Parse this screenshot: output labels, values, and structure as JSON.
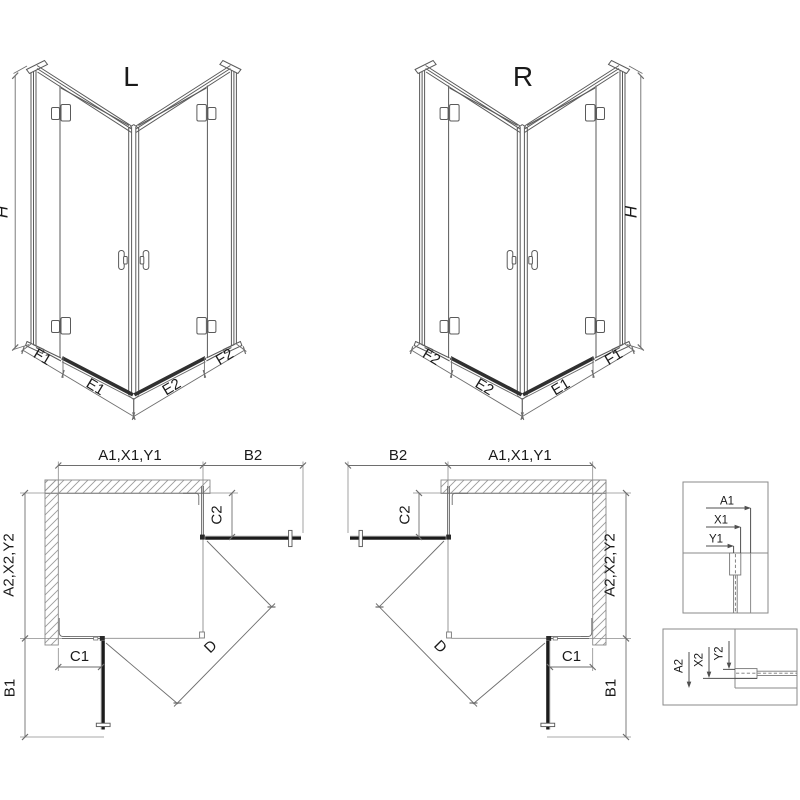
{
  "colors": {
    "line": "#5a5a5a",
    "dim": "#6e6e6e",
    "dark": "#1b1b1b",
    "threshold": "#303030",
    "hatch": "#9b9b9b",
    "frame": "#8a8a8a",
    "text": "#1a1a1a",
    "background": "#ffffff"
  },
  "iso_left": {
    "variant": "L",
    "height": "H",
    "seg1": "F1",
    "seg2": "E1",
    "seg3": "E2",
    "seg4": "F2"
  },
  "iso_right": {
    "variant": "R",
    "height": "H",
    "seg1": "F2",
    "seg2": "E2",
    "seg3": "E1",
    "seg4": "F1"
  },
  "plan_left": {
    "width_top": "A1,X1,Y1",
    "swing_top": "B2",
    "fixed_top": "C2",
    "depth_side": "A2,X2,Y2",
    "fixed_front": "C1",
    "swing_front": "B1",
    "diagonal": "D"
  },
  "plan_right": {
    "swing_top": "B2",
    "width_top": "A1,X1,Y1",
    "fixed_top": "C2",
    "depth_side": "A2,X2,Y2",
    "fixed_front": "C1",
    "swing_front": "B1",
    "diagonal": "D"
  },
  "detail_wall_profile": {
    "dim1": "A1",
    "dim2": "X1",
    "dim3": "Y1"
  },
  "detail_floor_profile": {
    "dim1": "A2",
    "dim2": "X2",
    "dim3": "Y2"
  }
}
